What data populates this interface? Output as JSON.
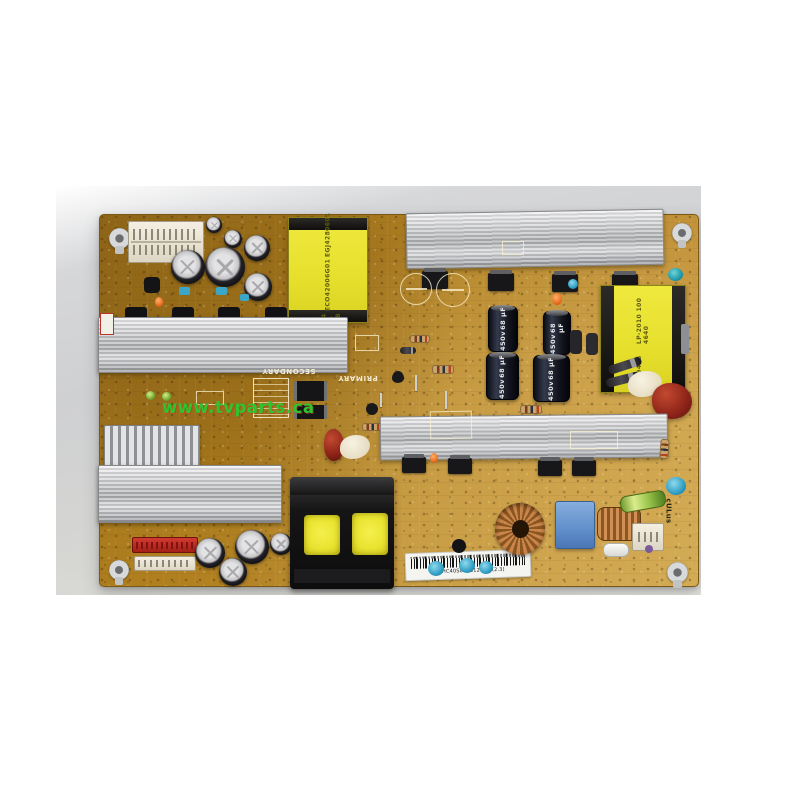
{
  "watermark": {
    "text": "www.tvparts.ca",
    "color": "#2ec42e"
  },
  "board": {
    "silkscreen": {
      "primary": "PRIMARY",
      "secondary": "SECONDARY"
    },
    "transformer_top_label": {
      "line1": "LS-D04 SC-D3B",
      "line2": "ECO42006G01",
      "line3": "EGJ4280601"
    },
    "transformer_right_label": {
      "line1": "30419486 S1F",
      "line2": "LP-2010 100 4640"
    },
    "bulk_capacitor": {
      "series": "LT",
      "voltage": "450v",
      "capacitance": "68 µF",
      "temp": "105°C(M)"
    },
    "barcode_label": {
      "text": "B88HC40S044812052 (2.3)"
    },
    "safety_mark": {
      "text": "cULus"
    }
  },
  "colors": {
    "pcb": "#b5852a",
    "photo_bg": "#cfd0d2",
    "heatsink": "#c6c7c9",
    "transformer_yellow": "#e8e432"
  }
}
